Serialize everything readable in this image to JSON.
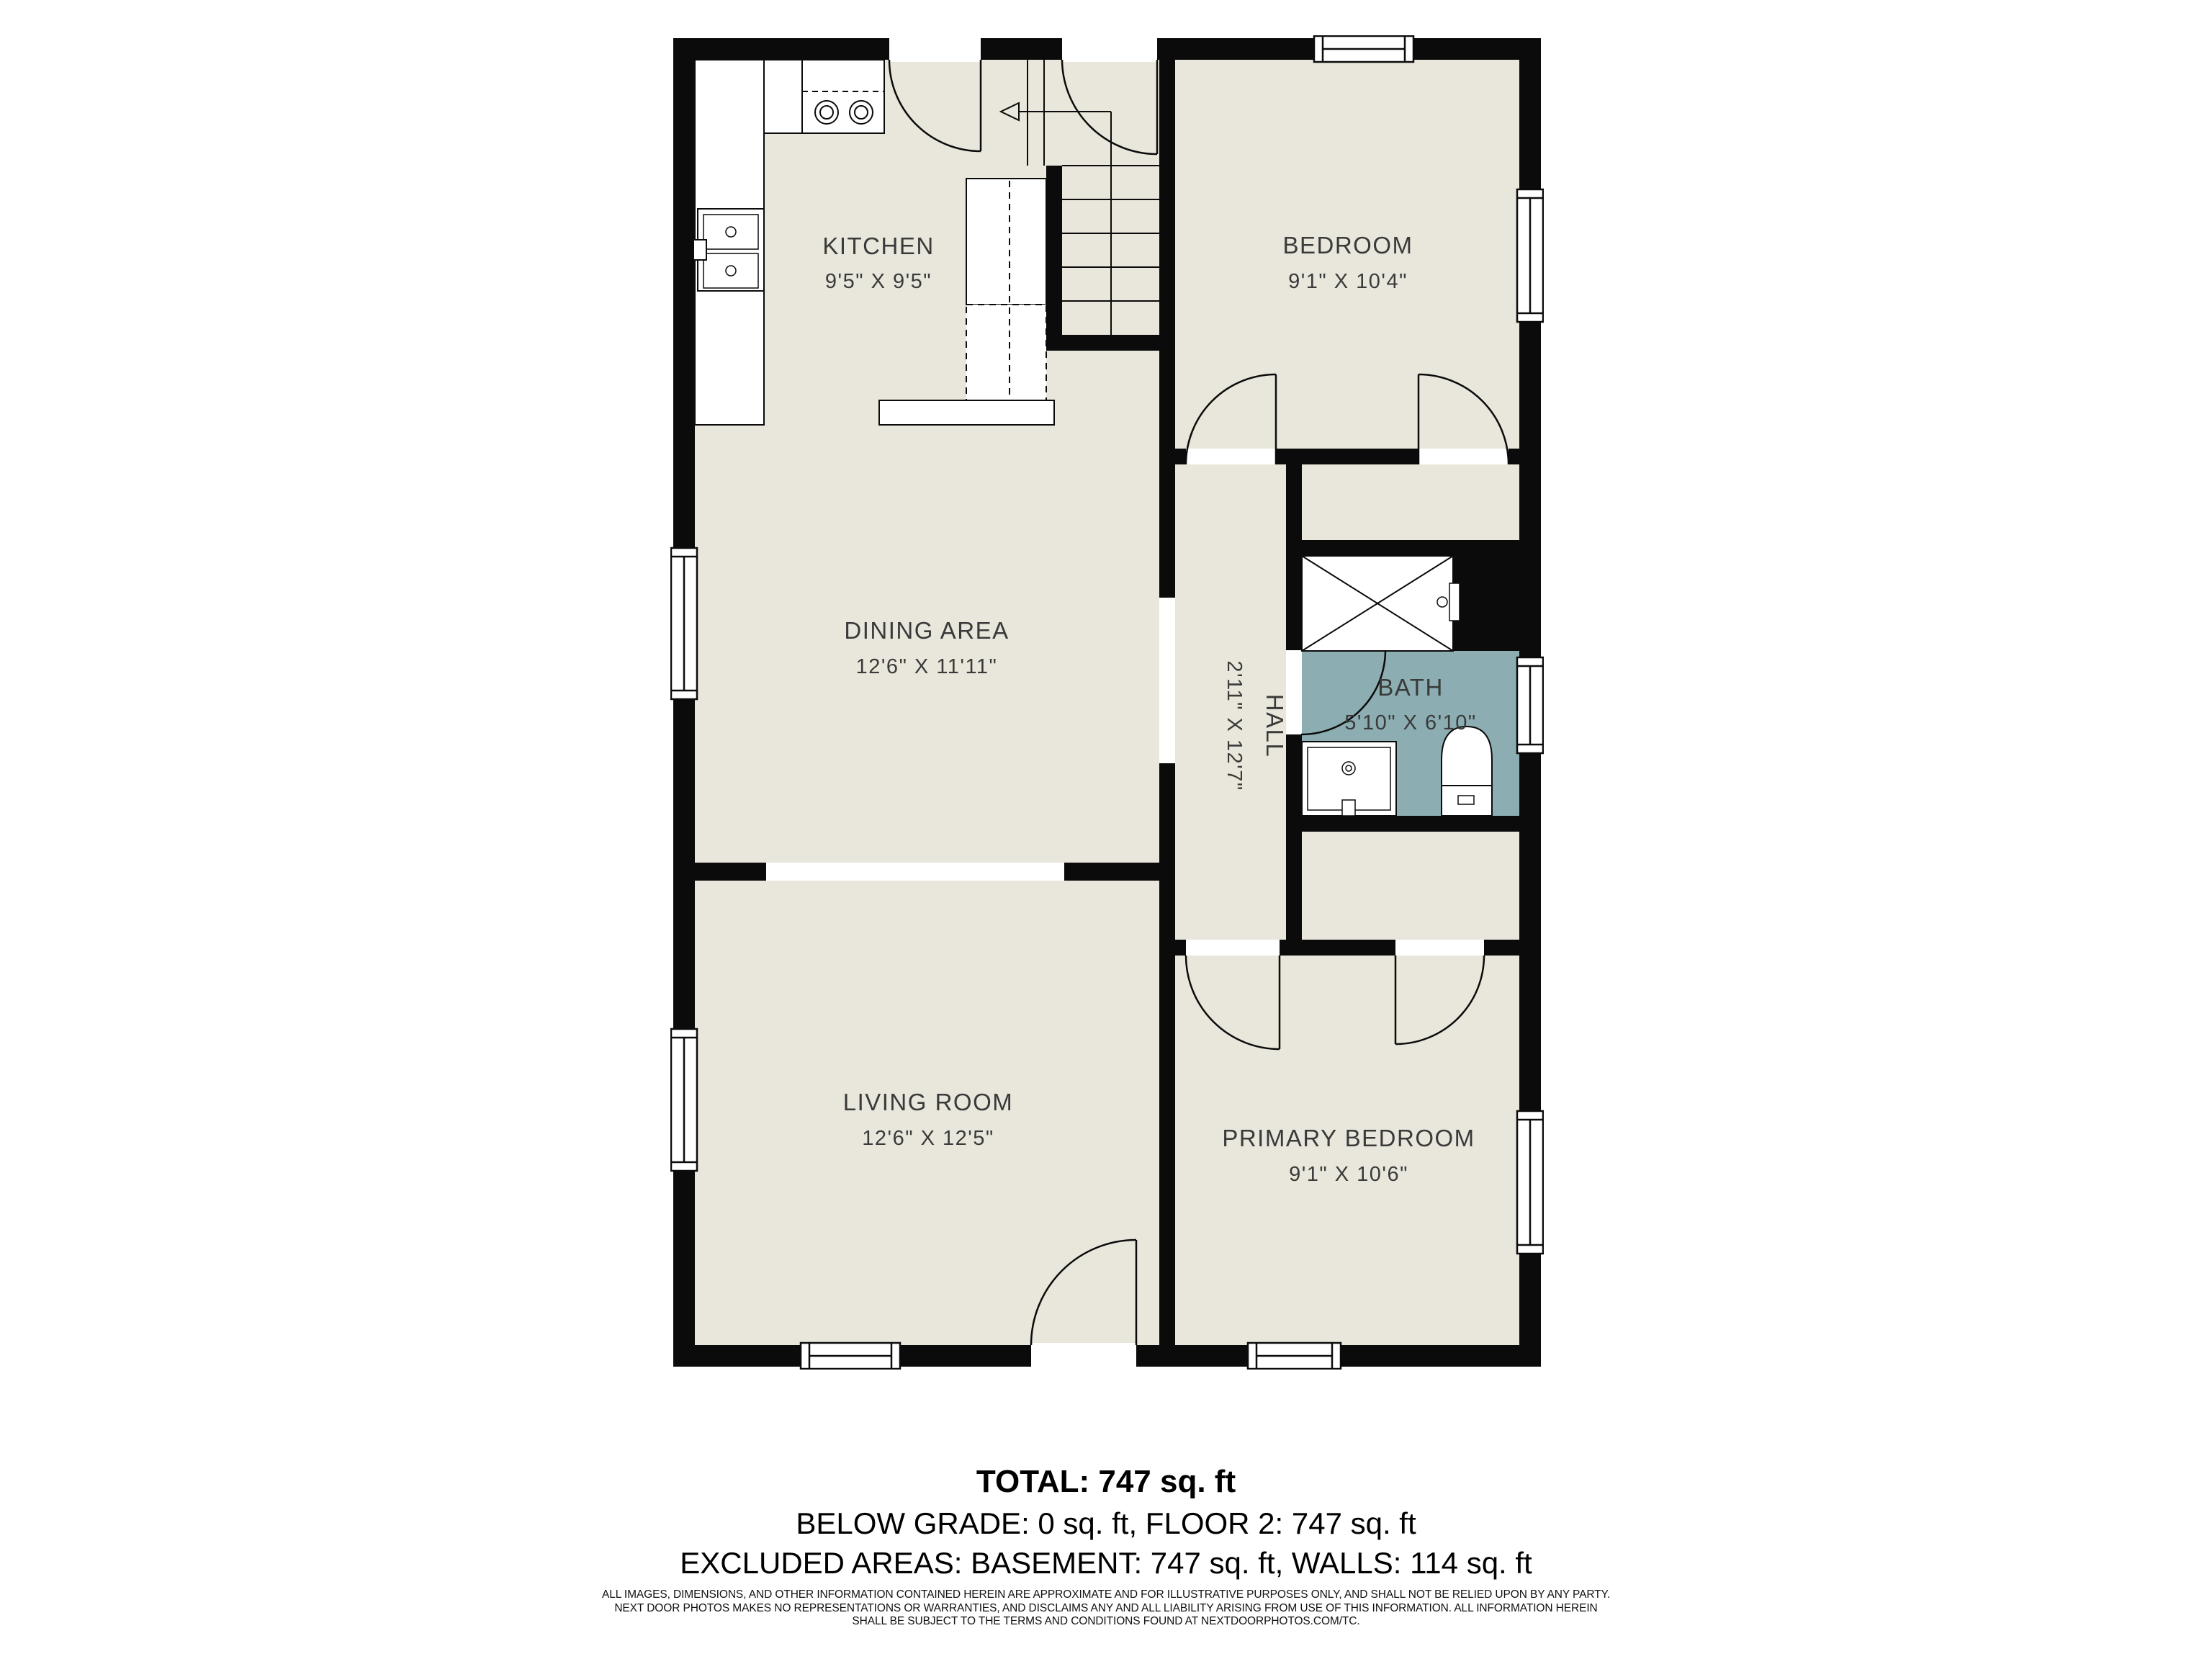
{
  "floorplan": {
    "rooms": [
      {
        "name": "KITCHEN",
        "dims": "9'5\" X 9'5\""
      },
      {
        "name": "BEDROOM",
        "dims": "9'1\" X 10'4\""
      },
      {
        "name": "DINING AREA",
        "dims": "12'6\" X 11'11\""
      },
      {
        "name": "HALL",
        "dims": "2'11\" X 12'7\""
      },
      {
        "name": "BATH",
        "dims": "5'10\" X 6'10\""
      },
      {
        "name": "LIVING ROOM",
        "dims": "12'6\" X 12'5\""
      },
      {
        "name": "PRIMARY BEDROOM",
        "dims": "9'1\" X 10'6\""
      }
    ],
    "colors": {
      "floor": "#e9e7dc",
      "bath": "#8cadb2",
      "wall": "#0b0b0b"
    }
  },
  "summary": {
    "total": "TOTAL: 747 sq. ft",
    "line2": "BELOW GRADE: 0 sq. ft, FLOOR 2: 747 sq. ft",
    "line3": "EXCLUDED AREAS: BASEMENT: 747 sq. ft, WALLS: 114 sq. ft"
  },
  "disclaimer": {
    "line1": "ALL IMAGES, DIMENSIONS, AND OTHER INFORMATION CONTAINED HEREIN ARE APPROXIMATE AND FOR ILLUSTRATIVE PURPOSES ONLY, AND SHALL NOT BE RELIED UPON BY ANY PARTY.",
    "line2": "NEXT DOOR PHOTOS MAKES NO REPRESENTATIONS OR WARRANTIES, AND DISCLAIMS ANY AND ALL LIABILITY ARISING FROM USE OF THIS INFORMATION. ALL INFORMATION HEREIN",
    "line3": "SHALL BE SUBJECT TO THE TERMS AND CONDITIONS FOUND AT NEXTDOORPHOTOS.COM/TC."
  }
}
